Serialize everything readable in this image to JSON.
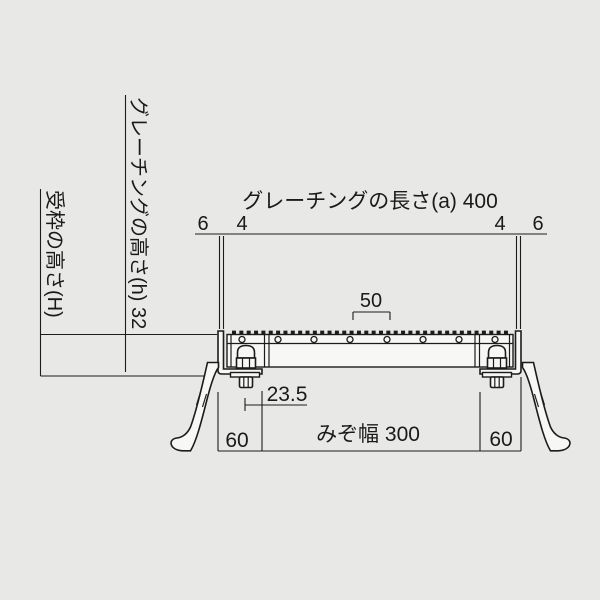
{
  "drawing": {
    "type": "grating-cross-section-technical-drawing",
    "colors": {
      "background": "#e8e8e7",
      "line": "#1c1c1c",
      "shape_fill": "#f7f7f5"
    },
    "labels": {
      "grating_length": "グレーチングの長さ(a) 400",
      "end_thickness_left": "6",
      "end_clearance_left": "4",
      "end_clearance_right": "4",
      "end_thickness_right": "6",
      "crossbar_pitch": "50",
      "bolt_offset": "23.5",
      "seat_width_left": "60",
      "groove_width": "みぞ幅 300",
      "seat_width_right": "60",
      "frame_height": "受枠の高さ(H)",
      "grating_height": "グレーチングの高さ(h) 32"
    }
  }
}
